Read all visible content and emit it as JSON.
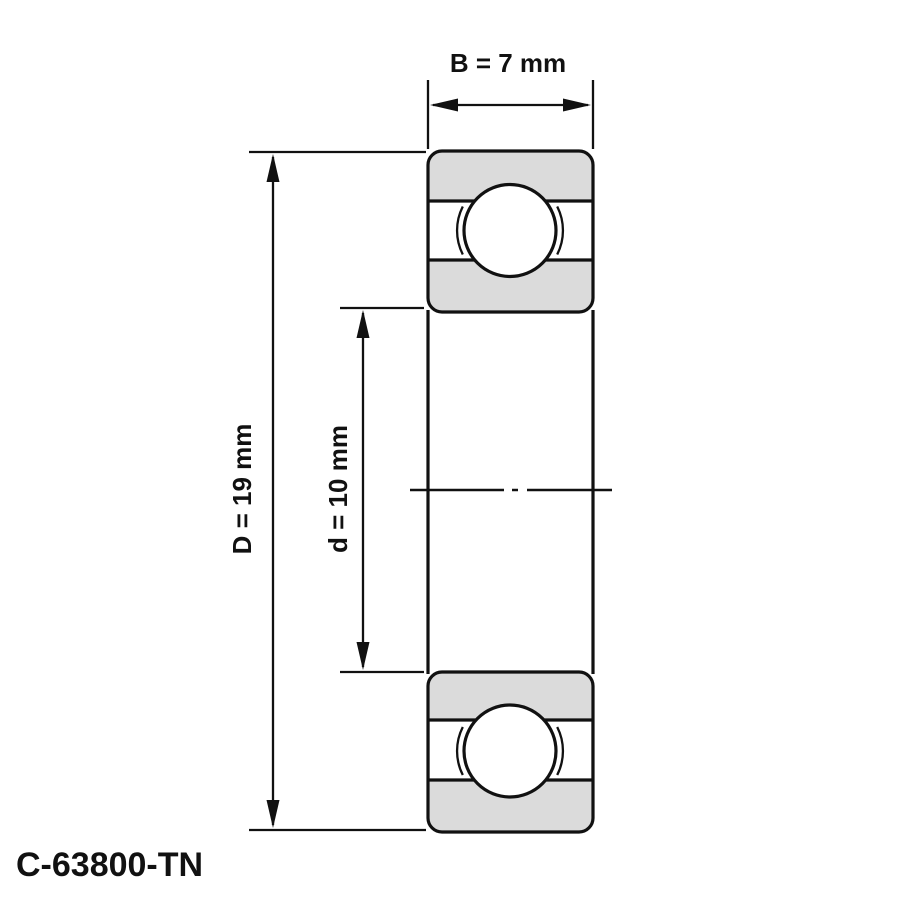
{
  "labels": {
    "width_dim": "B = 7 mm",
    "outer_diameter_dim": "D = 19 mm",
    "bore_diameter_dim": "d = 10 mm",
    "part_number": "C-63800-TN"
  },
  "dimensions_mm": {
    "B": 7,
    "D": 19,
    "d": 10
  },
  "colors": {
    "line": "#111111",
    "ring_fill": "#dbdbdb",
    "background": "#ffffff"
  }
}
